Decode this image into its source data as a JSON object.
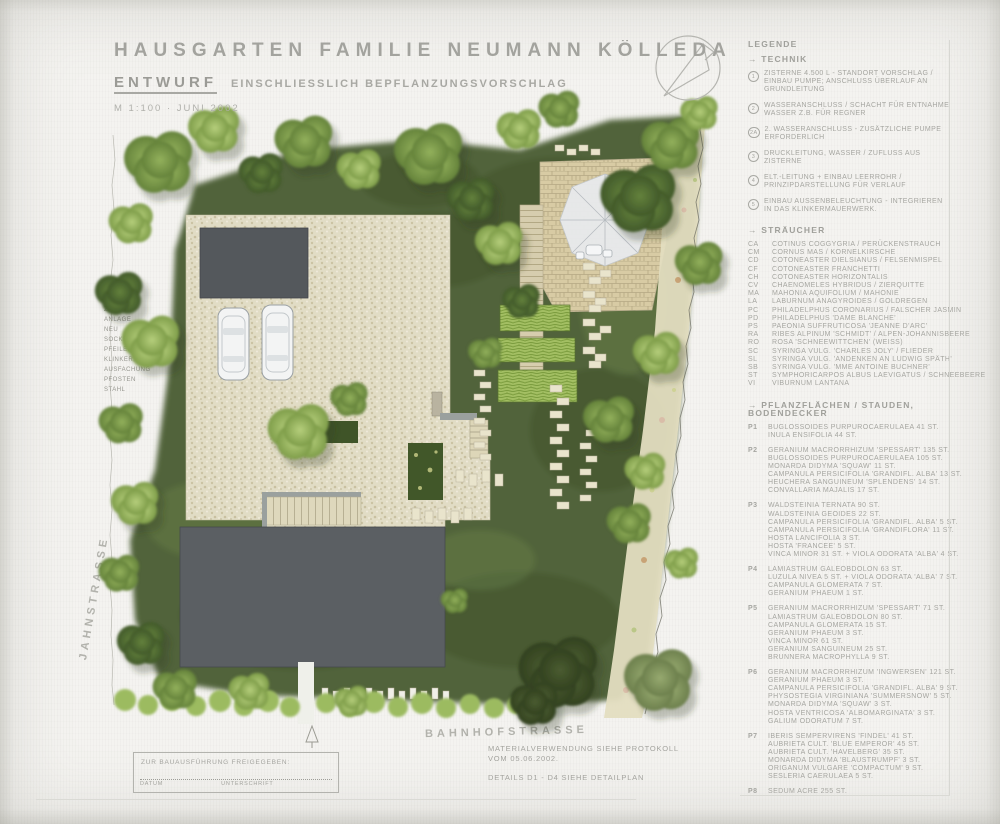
{
  "title": {
    "main": "HAUSGARTEN FAMILIE NEUMANN KÖLLEDA",
    "entwurf": "ENTWURF",
    "including": "EINSCHLIESSLICH BEPFLANZUNGSVORSCHLAG",
    "scale_date": "M 1:100  ·  JUNI 2002"
  },
  "legend": {
    "heading": "LEGENDE",
    "technik_heading": "→ TECHNIK",
    "technik": [
      {
        "num": "1",
        "text": "ZISTERNE 4.500 L - STANDORT VORSCHLAG / EINBAU PUMPE; ANSCHLUSS ÜBERLAUF AN GRUNDLEITUNG"
      },
      {
        "num": "2",
        "text": "WASSERANSCHLUSS / SCHACHT FÜR ENTNAHME WASSER Z.B. FÜR REGNER"
      },
      {
        "num": "2A",
        "text": "2. WASSERANSCHLUSS - ZUSÄTZLICHE PUMPE ERFORDERLICH"
      },
      {
        "num": "3",
        "text": "DRUCKLEITUNG, WASSER / ZUFLUSS AUS ZISTERNE"
      },
      {
        "num": "4",
        "text": "ELT.-LEITUNG + EINBAU LEERROHR / PRINZIPDARSTELLUNG FÜR VERLAUF"
      },
      {
        "num": "5",
        "text": "EINBAU AUSSENBELEUCHTUNG - INTEGRIEREN IN DAS KLINKERMAUERWERK."
      }
    ],
    "straeucher_heading": "→ STRÄUCHER",
    "straeucher": [
      {
        "abbr": "CA",
        "name": "COTINUS COGGYGRIA / PERÜCKENSTRAUCH"
      },
      {
        "abbr": "CM",
        "name": "CORNUS MAS / KORNELKIRSCHE"
      },
      {
        "abbr": "CD",
        "name": "COTONEASTER DIELSIANUS / FELSENMISPEL"
      },
      {
        "abbr": "CF",
        "name": "COTONEASTER FRANCHETTI"
      },
      {
        "abbr": "CH",
        "name": "COTONEASTER HORIZONTALIS"
      },
      {
        "abbr": "CV",
        "name": "CHAENOMELES HYBRIDUS / ZIERQUITTE"
      },
      {
        "abbr": "MA",
        "name": "MAHONIA AQUIFOLIUM / MAHONIE"
      },
      {
        "abbr": "LA",
        "name": "LABURNUM ANAGYROIDES / GOLDREGEN"
      },
      {
        "abbr": "PC",
        "name": "PHILADELPHUS CORONARIUS / FALSCHER JASMIN"
      },
      {
        "abbr": "PD",
        "name": "PHILADELPHUS 'DAME BLANCHE'"
      },
      {
        "abbr": "PS",
        "name": "PAEONIA SUFFRUTICOSA 'JEANNE D'ARC'"
      },
      {
        "abbr": "RA",
        "name": "RIBES ALPINUM 'SCHMIDT' / ALPEN-JOHANNISBEERE"
      },
      {
        "abbr": "RO",
        "name": "ROSA 'SCHNEEWITTCHEN' (WEISS)"
      },
      {
        "abbr": "SC",
        "name": "SYRINGA VULG. 'CHARLES JOLY' / FLIEDER"
      },
      {
        "abbr": "SL",
        "name": "SYRINGA VULG. 'ANDENKEN AN LUDWIG SPÄTH'"
      },
      {
        "abbr": "SB",
        "name": "SYRINGA VULG. 'MME ANTOINE BUCHNER'"
      },
      {
        "abbr": "ST",
        "name": "SYMPHORICARPOS ALBUS LAEVIGATUS / SCHNEEBEERE"
      },
      {
        "abbr": "VI",
        "name": "VIBURNUM LANTANA"
      }
    ],
    "pflanz_heading": "→ PFLANZFLÄCHEN / STAUDEN, BODENDECKER",
    "pflanzflaechen": [
      {
        "code": "P1",
        "lines": [
          "BUGLOSSOIDES PURPUROCAERULAEA  41 ST.",
          "INULA ENSIFOLIA  44 ST."
        ]
      },
      {
        "code": "P2",
        "lines": [
          "GERANIUM MACRORRHIZUM 'SPESSART'  135 ST.",
          "BUGLOSSOIDES PURPUROCAERULAEA  105 ST.",
          "MONARDA DIDYMA 'SQUAW'  11 ST.",
          "CAMPANULA PERSICIFOLIA 'GRANDIFL. ALBA'  13 ST.",
          "HEUCHERA SANGUINEUM 'SPLENDENS'  14 ST.",
          "CONVALLARIA MAJALIS  17 ST."
        ]
      },
      {
        "code": "P3",
        "lines": [
          "WALDSTEINIA TERNATA  90 ST.",
          "WALDSTEINIA GEOIDES  22 ST.",
          "CAMPANULA PERSICIFOLIA 'GRANDIFL. ALBA' 5 ST.",
          "CAMPANULA PERSICIFOLIA 'GRANDIFLORA'  11 ST.",
          "HOSTA LANCIFOLIA  3 ST.",
          "HOSTA 'FRANCEE'  5 ST.",
          "VINCA MINOR  31 ST. + VIOLA ODORATA 'ALBA' 4 ST."
        ]
      },
      {
        "code": "P4",
        "lines": [
          "LAMIASTRUM GALEOBDOLON  63 ST.",
          "LUZULA NIVEA  5 ST. + VIOLA ODORATA 'ALBA' 7 ST.",
          "CAMPANULA GLOMERATA  7 ST.",
          "GERANIUM PHAEUM  1 ST."
        ]
      },
      {
        "code": "P5",
        "lines": [
          "GERANIUM MACRORRHIZUM 'SPESSART'  71 ST.",
          "LAMIASTRUM GALEOBDOLON  80 ST.",
          "CAMPANULA GLOMERATA  15 ST.",
          "GERANIUM PHAEUM  3 ST.",
          "VINCA MINOR  61 ST.",
          "GERANIUM SANGUINEUM  25 ST.",
          "BRUNNERA MACROPHYLLA  9 ST."
        ]
      },
      {
        "code": "P6",
        "lines": [
          "GERANIUM MACRORRHIZUM 'INGWERSEN'  121 ST.",
          "GERANIUM PHAEUM  3 ST.",
          "CAMPANULA PERSICIFOLIA 'GRANDIFL. ALBA' 9 ST.",
          "PHYSOSTEGIA VIRGINIANA 'SUMMERSNOW'  5 ST.",
          "MONARDA DIDYMA 'SQUAW'  3 ST.",
          "HOSTA VENTRICOSA 'ALBOMARGINATA'  3 ST.",
          "GALIUM ODORATUM  7 ST."
        ]
      },
      {
        "code": "P7",
        "lines": [
          "IBERIS SEMPERVIRENS 'FINDEL'  41 ST.",
          "AUBRIETA CULT. 'BLUE EMPEROR'  45 ST.",
          "AUBRIETA CULT. 'HAVELBERG'  35 ST.",
          "MONARDA DIDYMA 'BLAUSTRUMPF'  3 ST.",
          "ORIGANUM VULGARE 'COMPACTUM'  9 ST.",
          "SESLERIA CAERULAEA  5 ST."
        ]
      },
      {
        "code": "P8",
        "lines": [
          "SEDUM ACRE  255 ST."
        ]
      }
    ]
  },
  "plan": {
    "street_left": "JAHNSTRASSE",
    "street_bottom": "BAHNHOFSTRASSE",
    "fence_note_lines": [
      "ZAUN-",
      "ANLAGE",
      "NEU",
      "SOCKEL UND",
      "PFEILER",
      "KLINKER,",
      "AUSFACHUNG",
      "PFOSTEN",
      "STAHL"
    ]
  },
  "notes": {
    "material_line1": "MATERIALVERWENDUNG SIEHE PROTOKOLL",
    "material_line2": "VOM 05.06.2002.",
    "details_line": "DETAILS  D1 - D4  SIEHE DETAILPLAN"
  },
  "stamp": {
    "release_line": "ZUR BAUAUSFÜHRUNG FREIGEGEBEN:",
    "date_label": "DATUM",
    "sign_label": "UNTERSCHRIFT"
  },
  "colors": {
    "paper": "#f4f3f0",
    "pencil_text": "#a6a6a1",
    "lawn": "#51633b",
    "tree_light": "#a9c46d",
    "tree_mid": "#84a351",
    "tree_dark": "#5d7a38",
    "gravel": "#e1dcc5",
    "klinker": "#d8cba4",
    "building_gray": "#585c60",
    "bed_green": "#a3bf63"
  }
}
